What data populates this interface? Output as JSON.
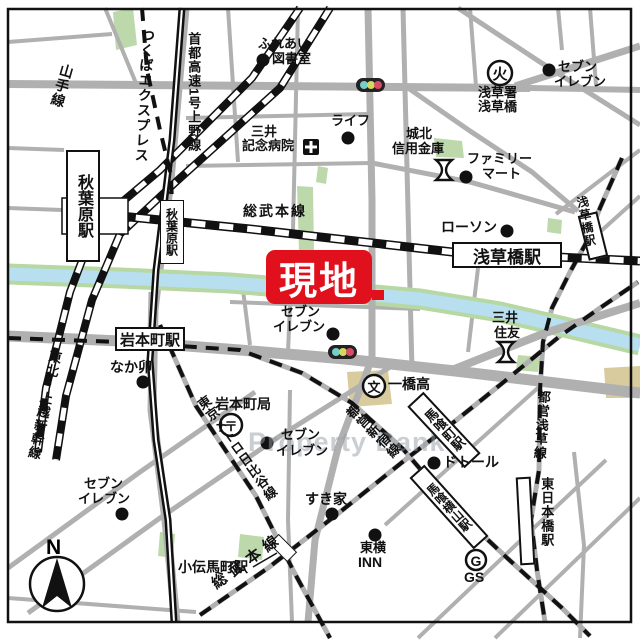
{
  "callout": {
    "label": "現地"
  },
  "watermark": {
    "text": "Property Bank"
  },
  "compass": {
    "n": "N"
  },
  "lines": {
    "yamanote": "山手線",
    "tsukuba_express": "つくばエクスプレス",
    "shuto_expwy": "首都高速1号上野線",
    "sobu_main": "総武本線",
    "sobu_rapid": "総武本線",
    "tohoku_joetsu": "東北・上越新幹線",
    "hibiya": "東京メトロ日比谷線",
    "toei_shinjuku": "都営新宿線",
    "toei_asakusa": "都営浅草線"
  },
  "stations": {
    "akihabara_jr": "秋葉原駅",
    "akihabara_tx": "秋葉原駅",
    "iwamotocho": "岩本町駅",
    "asakusabashi_jr": "浅草橋駅",
    "asakusabashi_toei": "浅草橋駅",
    "bakurocho": "馬喰町駅",
    "bakuroyokoyama": "馬喰横山駅",
    "higashi_nihonbashi": "東日本橋駅",
    "kodenmacho": "小伝馬町駅"
  },
  "pois": {
    "fureai": {
      "l1": "ふれあい",
      "l2": "図書室"
    },
    "life": {
      "label": "ライフ"
    },
    "mitsui_hospital": {
      "l1": "三井",
      "l2": "記念病院"
    },
    "johoku_shinkin": {
      "l1": "城北",
      "l2": "信用金庫"
    },
    "family_mart": {
      "l1": "ファミリー",
      "l2": "マート"
    },
    "asakusa_fire": {
      "l1": "浅草署",
      "l2": "浅草橋"
    },
    "seven_top_right": {
      "l1": "セブン",
      "l2": "イレブン"
    },
    "lawson": {
      "label": "ローソン"
    },
    "seven_central": {
      "l1": "セブン",
      "l2": "イレブン"
    },
    "mitsui_sumitomo": {
      "l1": "三井",
      "l2": "住友"
    },
    "nakau": {
      "label": "なか卯"
    },
    "iwamoto_post": {
      "label": "岩本町局"
    },
    "hitotsubashi": {
      "label": "一橋高"
    },
    "seven_mid": {
      "l1": "セブン",
      "l2": "イレブン"
    },
    "dotoru": {
      "label": "ドトール"
    },
    "sukiya": {
      "label": "すき家"
    },
    "toyoko_inn": {
      "l1": "東横",
      "l2": "INN"
    },
    "gs": {
      "label": "GS"
    },
    "seven_bottom_left": {
      "l1": "セブン",
      "l2": "イレブン"
    }
  },
  "symbols": {
    "post": "〒",
    "school": "文",
    "fire": "火",
    "gas": "G"
  },
  "colors": {
    "accent_red": "#e0111c",
    "river_blue": "#b7dff0",
    "bank_green": "#b7d8a3",
    "park_green": "#bdd9ab",
    "school_tan": "#d8cc9e",
    "road_gray": "#b0b0b0",
    "rail_black": "#111111"
  }
}
